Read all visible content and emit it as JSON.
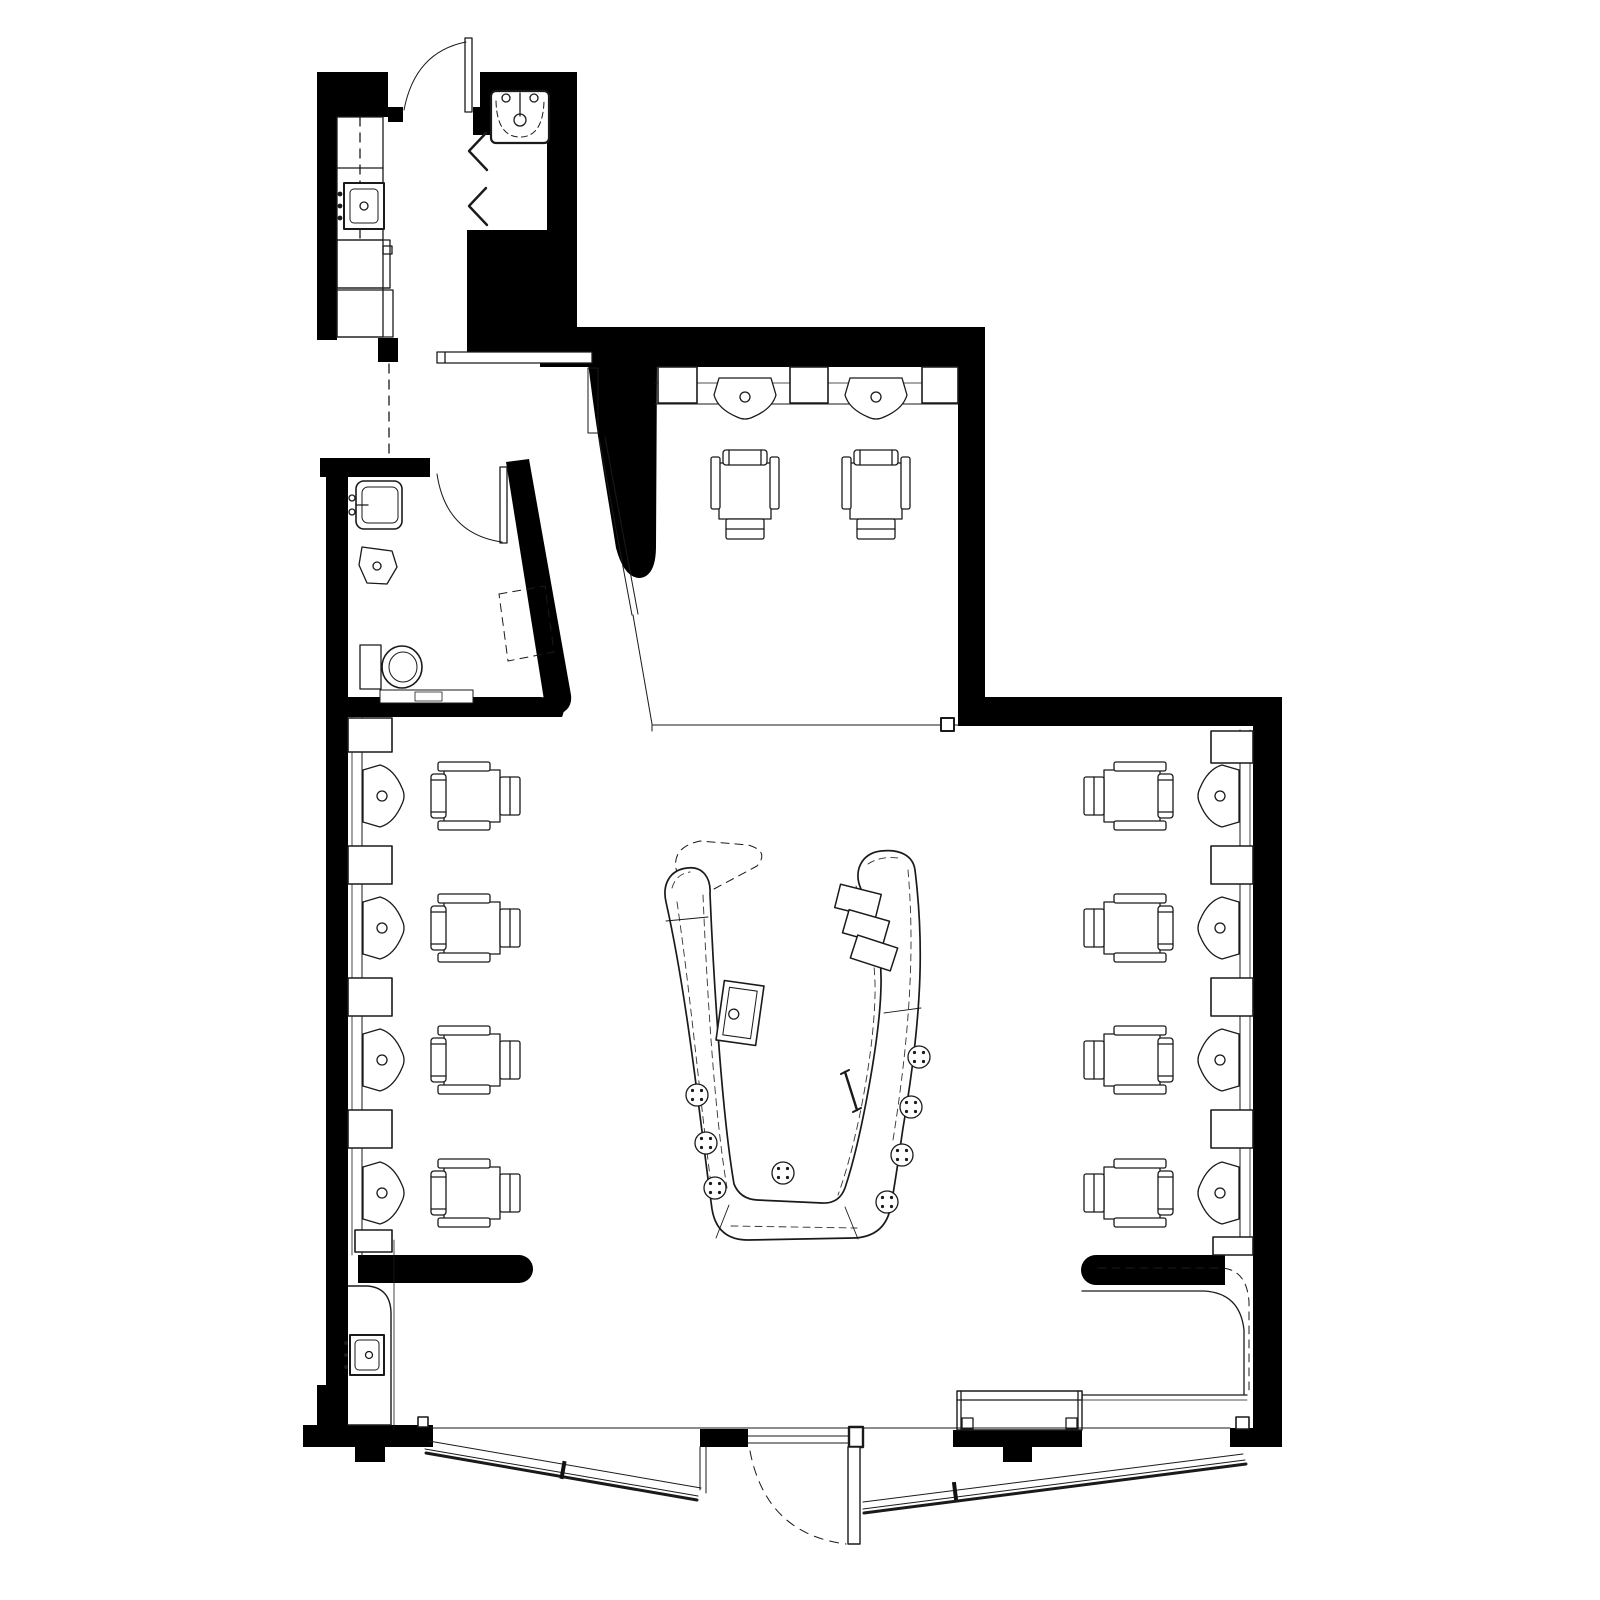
{
  "meta": {
    "type": "architectural-floor-plan",
    "subject": "salon interior fit-out plan",
    "style": "black and white line drawing, plan view",
    "background_color": "#ffffff",
    "wall_fill_color": "#000000",
    "line_color": "#1a1a1a",
    "dashed_elements": "overhead canopies, door swings, mirrors, cased openings"
  },
  "rooms": {
    "kitchenette_corridor": {
      "label": "kitchenette-corridor",
      "fixtures": {
        "counter_sections": 4,
        "sink": 1,
        "dashed_centerline": true,
        "pass_through_counter": 1
      },
      "entry_door_top": true
    },
    "washroom_top": {
      "label": "washroom",
      "fixtures": {
        "large_sink": 1,
        "wall_hooks": 2
      },
      "door": true
    },
    "restroom": {
      "label": "restroom",
      "fixtures": {
        "wall_sink": 1,
        "corner_basin": 1,
        "toilet": 1,
        "dashed_mirror_panel": 1
      },
      "door": true,
      "angled_wall": true
    },
    "treatment_room": {
      "label": "treatment-room",
      "shampoo_bowls": 2,
      "styling_chairs": 2,
      "wall_niches": 3,
      "sliding_door": true
    },
    "main_salon": {
      "label": "main-salon",
      "left_wall": {
        "stations": 4,
        "shampoo_bowls": 4,
        "styling_chairs": 4,
        "cabinets": 5
      },
      "right_wall": {
        "stations": 4,
        "shampoo_bowls": 4,
        "styling_chairs": 4,
        "cabinets": 5
      },
      "island": {
        "shape": "U-shaped bar",
        "stools": 8,
        "stools_left": 3,
        "stools_right": 4,
        "stools_inside": 1,
        "sink": 1,
        "storage_boxes": 3,
        "service_rail": 1,
        "dashed_overhead_canopy": true
      },
      "reception_nook": {
        "counter": 1,
        "sink": 1
      },
      "corner_counter": 1,
      "window_bench": 1
    }
  },
  "storefront": {
    "configuration": "V-shaped angled glazing with recessed entry",
    "glazing_runs": 2,
    "mullions": 2,
    "piers": 3,
    "entry_door_swing": "outward, dashed arc"
  }
}
